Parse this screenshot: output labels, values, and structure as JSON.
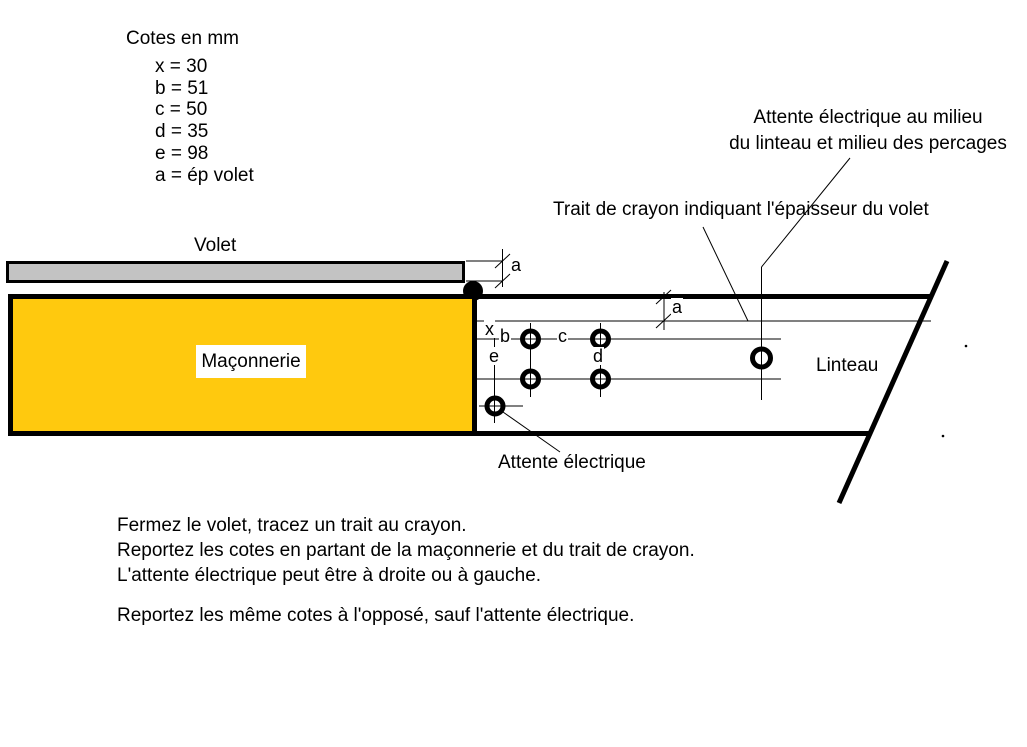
{
  "legend": {
    "title": "Cotes en mm",
    "items": [
      "x = 30",
      "b = 51",
      "c = 50",
      "d = 35",
      "e = 98",
      "a = ép volet"
    ]
  },
  "annotations": {
    "attente_milieu": [
      "Attente électrique au milieu",
      "du linteau et milieu des percages"
    ],
    "trait_crayon": "Trait de crayon indiquant l'épaisseur du volet",
    "attente_electrique": "Attente électrique"
  },
  "labels": {
    "volet": "Volet",
    "maconnerie": "Maçonnerie",
    "linteau": "Linteau"
  },
  "dims": {
    "a": "a",
    "b": "b",
    "c": "c",
    "d": "d",
    "e": "e",
    "x": "x"
  },
  "instructions": {
    "para1": [
      "Fermez le volet, tracez un trait au crayon.",
      "Reportez les cotes en partant de la maçonnerie et du trait de crayon.",
      "L'attente électrique peut être à droite ou à gauche."
    ],
    "para2": [
      "Reportez les même cotes à l'opposé, sauf l'attente électrique."
    ]
  },
  "colors": {
    "maconnerie_fill": "#FFC90E",
    "volet_fill": "#C3C3C3",
    "ink": "#000000"
  }
}
